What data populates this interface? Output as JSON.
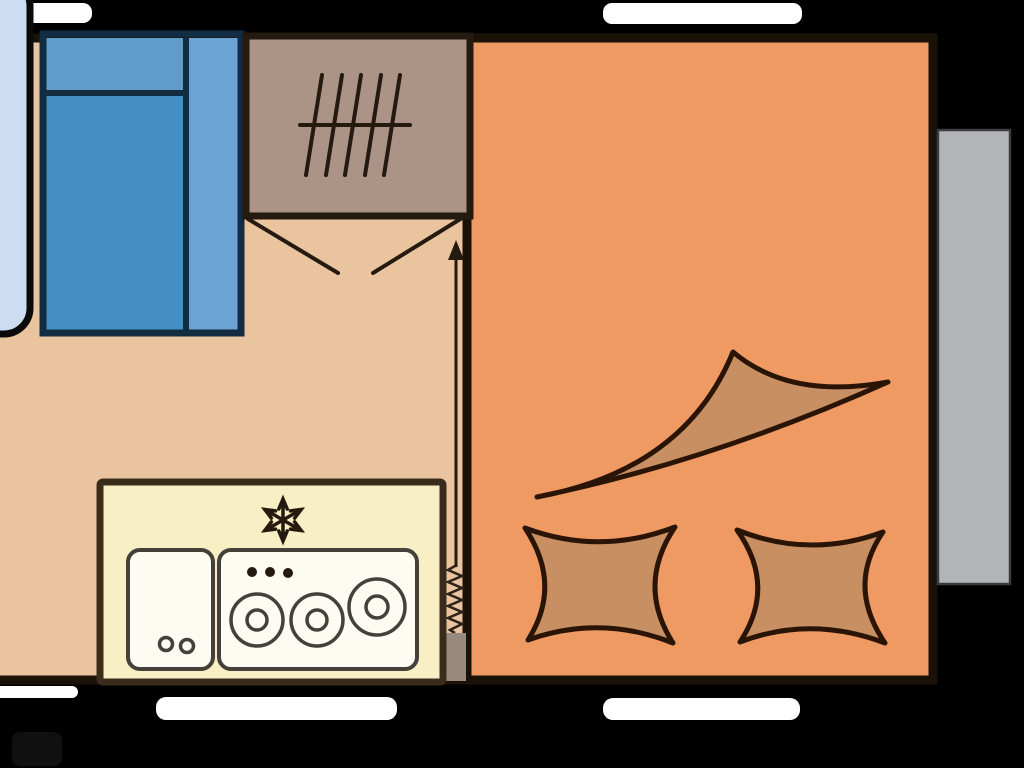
{
  "diagram": {
    "kind": "caravan-floor-plan",
    "rooms": [
      {
        "id": "bedroom-kitchen-area",
        "floor_color_key": "floor_left"
      },
      {
        "id": "lounge-area",
        "floor_color_key": "floor_right"
      }
    ],
    "furniture": [
      "front-lounge-panel",
      "double-bed",
      "wardrobe",
      "bifold-door",
      "entry-direction-arrow",
      "kitchen-unit",
      "sink",
      "hob-three-burners",
      "fridge-snowflake",
      "entry-spring",
      "entry-step",
      "wave-back-cushion",
      "seat-cushion-left",
      "seat-cushion-right",
      "slideout-panel"
    ],
    "icons": [
      {
        "name": "wardrobe-rail-icon",
        "glyph": "hanging-rail-with-5-hangers"
      },
      {
        "name": "snowflake-icon",
        "glyph": "six-arm-snowflake"
      },
      {
        "name": "burner-icon",
        "glyph": "double-circle"
      },
      {
        "name": "knob-dots-icon",
        "glyph": "three-dots"
      },
      {
        "name": "arrow-up-icon",
        "glyph": "straight-arrow"
      },
      {
        "name": "spring-icon",
        "glyph": "zigzag-coil"
      },
      {
        "name": "door-swing-icon",
        "glyph": "v-swing-lines"
      }
    ],
    "windows": {
      "top_left": true,
      "top_right": true,
      "bottom_left_small": true,
      "bottom_middle": true,
      "bottom_right": true
    }
  },
  "colors": {
    "background": "#000000",
    "wall": "#1a1209",
    "floor_left": "#e9c49e",
    "floor_right": "#f09a63",
    "window": "#ffffff",
    "front_panel": "#ccdcf2",
    "panel_outline": "#0a0a0a",
    "bed_pillow": "#5f9cca",
    "bed_main": "#4490c5",
    "bed_side": "#6ba3d2",
    "bed_outline": "#122c42",
    "wardrobe": "#ab9386",
    "symbol_dark": "#241a10",
    "kitchen": "#f8efc5",
    "kitchen_outline": "#3a2c1a",
    "appliance": "#fdfcf2",
    "appliance_outline": "#45413a",
    "cushion": "#c88f63",
    "cushion_outline": "#2a1405",
    "slideout": "#b3b4b6",
    "slideout_outline": "#3c3c3e",
    "step": "#9a8a7d",
    "coil": "#2a2118",
    "shadow": "#101010"
  }
}
